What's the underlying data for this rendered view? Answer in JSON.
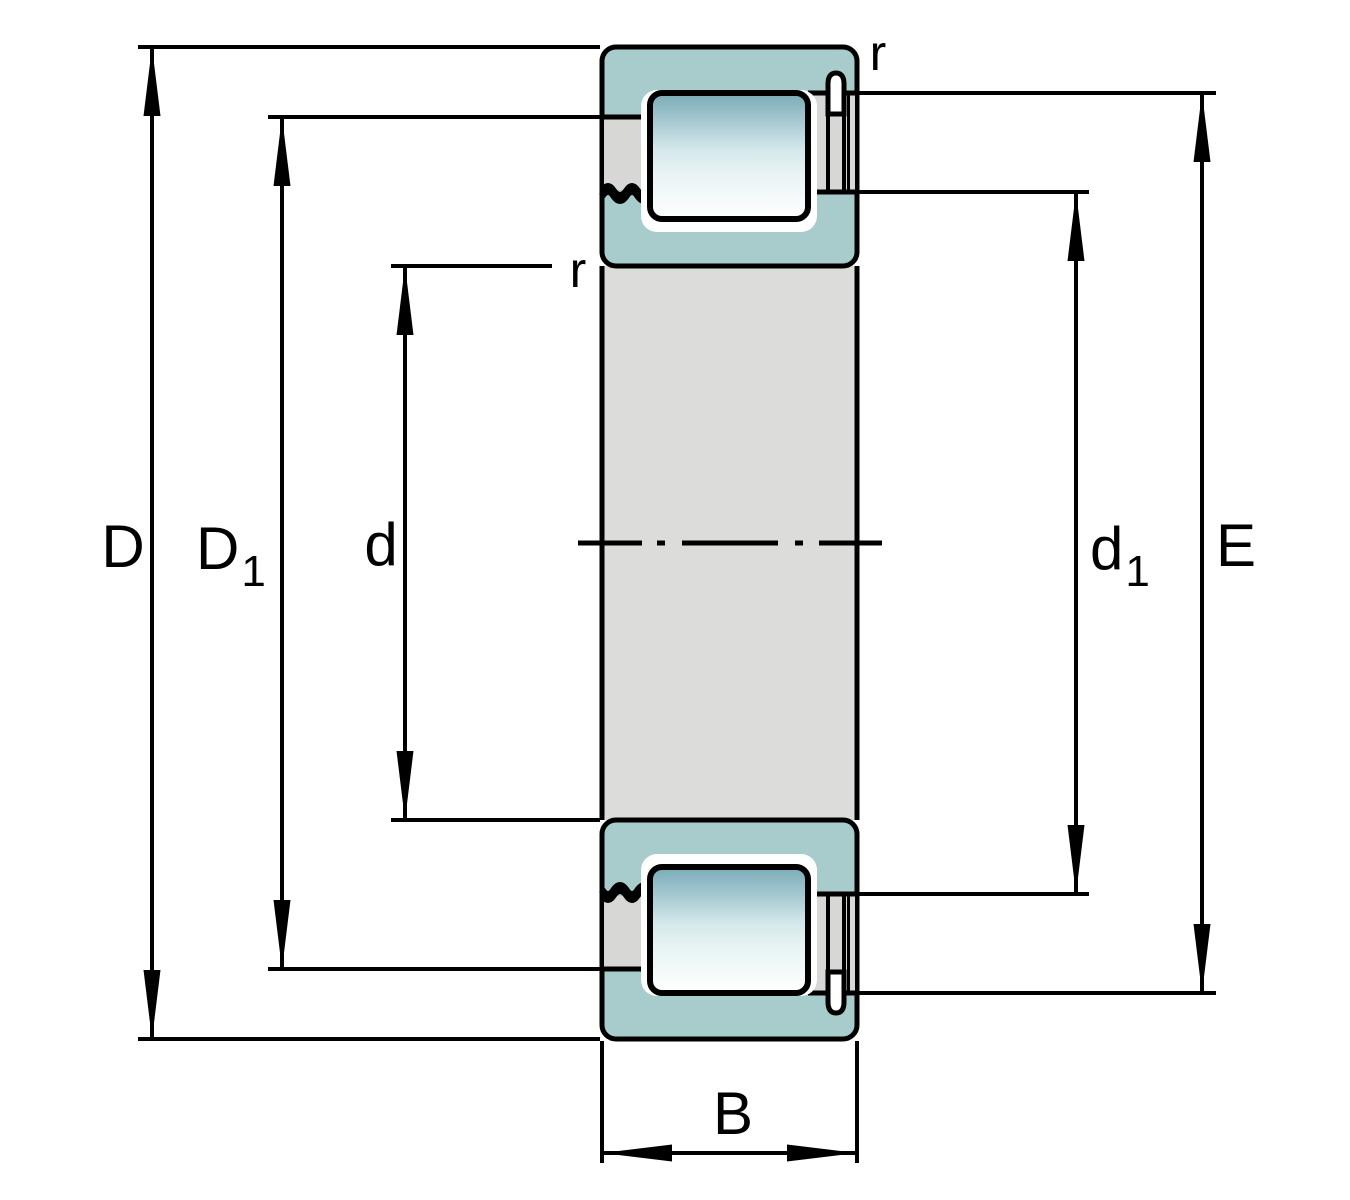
{
  "figure": {
    "type": "bearing-cross-section-dimension-drawing",
    "description": "Cylindrical roller bearing cross-section with boundary dimension annotations",
    "labels": {
      "D": "D",
      "D1_main": "D",
      "D1_sub": "1",
      "d": "d",
      "d1_main": "d",
      "d1_sub": "1",
      "E": "E",
      "B": "B",
      "r_outer": "r",
      "r_inner": "r"
    },
    "colors": {
      "outline": "#000000",
      "ring_teal": "#a8cccb",
      "part_gray": "#d7d8d5",
      "shaft_gray": "#dcdcda",
      "roller_top": "#79abb7",
      "roller_light": "#e9f4f5"
    }
  }
}
